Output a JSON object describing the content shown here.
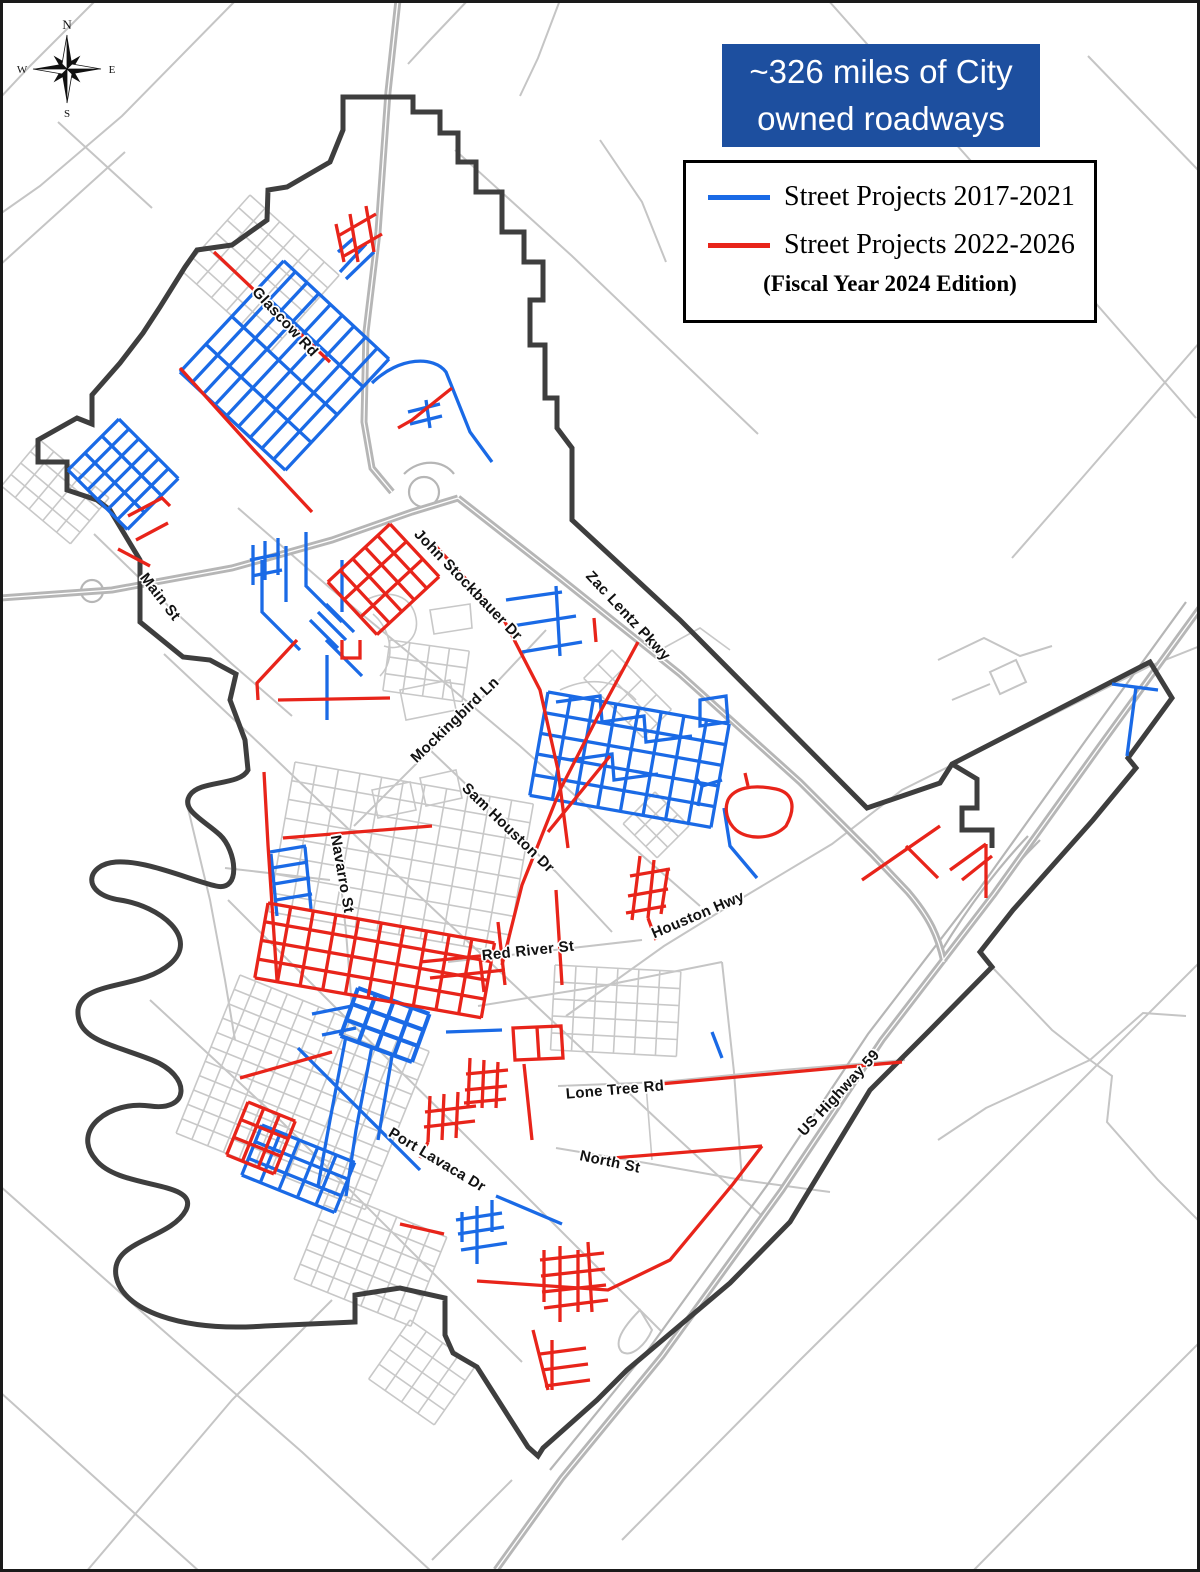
{
  "title_box": {
    "line1": "~326 miles of City",
    "line2": "owned roadways",
    "bg_color": "#1d4f9f",
    "text_color": "#ffffff"
  },
  "legend": {
    "items": [
      {
        "label": "Street Projects 2017-2021",
        "color": "#1a6ae6"
      },
      {
        "label": "Street Projects 2022-2026",
        "color": "#e8241a"
      }
    ],
    "note": "(Fiscal Year 2024 Edition)"
  },
  "compass": {
    "n": "N",
    "s": "S",
    "e": "E",
    "w": "W"
  },
  "street_labels": [
    {
      "text": "Glascow Rd",
      "x": 285,
      "y": 322,
      "angle": 47
    },
    {
      "text": "Main St",
      "x": 160,
      "y": 597,
      "angle": 52
    },
    {
      "text": "John Stockbauer Dr",
      "x": 468,
      "y": 585,
      "angle": 46
    },
    {
      "text": "Zac Lentz Pkwy",
      "x": 628,
      "y": 616,
      "angle": 47
    },
    {
      "text": "Mockingbird Ln",
      "x": 455,
      "y": 720,
      "angle": -44
    },
    {
      "text": "Sam Houston Dr",
      "x": 508,
      "y": 828,
      "angle": 44
    },
    {
      "text": "Navarro St",
      "x": 342,
      "y": 874,
      "angle": 80
    },
    {
      "text": "Red River St",
      "x": 528,
      "y": 951,
      "angle": -6
    },
    {
      "text": "Houston Hwy",
      "x": 698,
      "y": 915,
      "angle": -23
    },
    {
      "text": "Lone Tree Rd",
      "x": 615,
      "y": 1090,
      "angle": -5
    },
    {
      "text": "North St",
      "x": 610,
      "y": 1162,
      "angle": 12
    },
    {
      "text": "Port Lavaca Dr",
      "x": 437,
      "y": 1160,
      "angle": 31
    },
    {
      "text": "US Highway 59",
      "x": 839,
      "y": 1093,
      "angle": -47
    }
  ],
  "map": {
    "colors": {
      "county_roads": "#c5c5c5",
      "highways": "#b6b6b6",
      "city_streets": "#c8c8c8",
      "city_boundary": "#3e3e3e",
      "projects_2017_2021": "#1a6ae6",
      "projects_2022_2026": "#e8241a"
    },
    "layers": [
      {
        "name": "county-roads",
        "color": "#c5c5c5",
        "width": 2,
        "paths": [
          "M96,0 L30,66 L0,98",
          "M236,0 L122,116 L40,186 L0,214",
          "M0,265 L125,152",
          "M58,122 L152,208",
          "M468,0 L430,40 L408,64",
          "M560,0 L538,58 L520,96",
          "M828,0 L1002,196 L1196,418",
          "M912,92 L1014,56",
          "M1088,56 L1200,172",
          "M1200,342 L1082,478 L1012,558",
          "M0,1186 L142,1312 L302,1452 L432,1572",
          "M86,1572 L232,1400 L332,1300",
          "M0,1392 L122,1502 L200,1572",
          "M512,1480 L432,1560",
          "M1200,962 L1002,1160 L800,1360 L622,1540",
          "M972,1572 L1102,1440 L1200,1342",
          "M455,150 L572,256 L666,346 L758,434",
          "M566,1016 L664,946 L742,898 L832,844 L902,790 L1054,714 L1150,666 L1200,646",
          "M94,534 L162,600 L232,664 L292,716",
          "M354,826 L422,758 L482,698 L546,630",
          "M428,748 L472,790 L556,872 L612,932",
          "M448,962 L572,948 L642,940",
          "M558,1086 L662,1082 L782,1070 L905,1060",
          "M556,1148 L652,1164 L742,1180 L830,1192",
          "M336,836 L346,932 L352,1008",
          "M238,508 L330,588 L420,662 L520,746 L620,836 L700,906",
          "M164,654 L262,746 L362,842 L462,936 L562,1030 L662,1124 L762,1216",
          "M228,900 L340,1012 L452,1122 L562,1232 L662,1332",
          "M150,1000 L282,1122 L422,1262 L522,1362",
          "M478,1006 L602,986 L722,962",
          "M722,962 L734,1072 L742,1180",
          "M992,967 L1052,1030 L1090,1060 L1143,1013 L1186,1016",
          "M1090,1060 L1112,1076 L1107,1122 L1158,1180 L1200,1222",
          "M1090,1060 L986,1108 L938,1140",
          "M186,800 L210,900 L225,980 L235,1040",
          "M225,868 L330,880",
          "M938,660 L984,638 L1020,656 L1052,646",
          "M990,672 L1016,660 L1026,682 L1000,694 Z",
          "M952,700 L990,684",
          "M640,1310 C620,1330 614,1344 622,1352 C632,1358 646,1344 652,1330 Z",
          "M600,140 L642,202 L666,262"
        ]
      },
      {
        "name": "highways",
        "color": "#b6b6b6",
        "width": 7,
        "paths": [
          "M398,0 L388,92 L378,232 L366,332 L364,422 L372,468 L392,492",
          "M0,598 L112,590 L232,568 L332,540 L412,512 L458,498",
          "M458,498 L560,578 L680,674 L800,782 L872,854 L908,892 C930,918 938,936 944,962",
          "M1200,608 L1100,746 L994,894 L882,1040 L782,1190 L662,1356 L562,1478 L496,1570"
        ]
      },
      {
        "name": "highway-ramps",
        "color": "#b6b6b6",
        "width": 2.2,
        "paths": [
          "M404,474 C420,458 444,460 454,474",
          "M439,492 a15,15 0 1,0 -30,0 a15,15 0 1,0 30,0",
          "M103,591 a11,11 0 1,0 -22,0 a11,11 0 1,0 22,0",
          "M1040,840 C1000,880 970,920 948,958",
          "M1028,836 C992,874 964,914 942,950",
          "M1186,602 L1086,740 L980,888 L868,1034 L768,1184 L648,1350 L550,1470"
        ]
      },
      {
        "name": "highway-centerline",
        "color": "#ffffff",
        "width": 1.3,
        "paths": [
          "M398,0 L388,92 L378,232 L366,332 L364,422 L372,468 L392,492",
          "M0,598 L112,590 L232,568 L332,540 L412,512 L458,498",
          "M458,498 L560,578 L680,674 L800,782 L872,854 L908,892 C930,918 938,936 944,962",
          "M1200,608 L1100,746 L994,894 L882,1040 L782,1190 L662,1356 L562,1478 L496,1570"
        ]
      },
      {
        "name": "city-streets",
        "color": "#c8c8c8",
        "width": 1.6,
        "paths": [
          "M366,600 C390,588 412,596 416,618 C420,640 400,652 384,646",
          "M430,610 L470,604 L472,628 L434,634 Z",
          "M560,690 C590,676 618,680 636,700",
          "M660,650 L700,628 L730,650",
          "M372,790 L410,782 L416,810 L378,818 Z",
          "M420,778 L456,770 L462,798 L426,806 Z",
          "M646,1085 L652,1160",
          "M373,614 C392,630 396,660 380,676",
          "M400,690 L450,680 L456,710 L406,720 Z"
        ]
      },
      {
        "name": "city-boundary",
        "color": "#3e3e3e",
        "width": 5,
        "paths": [
          "M343,130 L343,97 L413,97 L413,112 L440,112 L440,133 L458,133 L458,162 L476,162 L476,192 L502,192 L502,232 L524,232 L524,262 L543,262 L543,300 L530,300 L530,345 L545,345 L545,398 L557,398 L557,428 L572,448 L572,520 L680,620 L867,808 L940,783 L952,764 L1150,662 L1172,698 L1128,758 L1136,768 L1093,820 L1013,910 L980,952 L992,967 L930,1030 L870,1090 L790,1222 L730,1283 L627,1370 L597,1400 L543,1448 L538,1456 L528,1447 L477,1367 L453,1353 L445,1335 L445,1298 L400,1288 L355,1295 L355,1322 L265,1326 C180,1332 122,1310 116,1276 C110,1240 170,1240 186,1210 C200,1180 120,1190 96,1160 C70,1130 110,1100 150,1106 C190,1112 192,1076 152,1060 C112,1044 76,1040 78,1010 C82,980 140,990 170,964 C200,938 160,906 120,900 C80,894 86,864 116,862 C146,860 190,880 216,886 C242,892 236,850 220,835 C204,820 180,810 190,795 C200,780 240,786 248,770 L245,740 L230,700 L236,674 L210,660 L183,657 L140,622 L140,560 L110,510 L97,500 L67,490 L67,462 L38,462 L38,440 L77,418 L92,424 L92,395 L120,363 L143,333 L160,307 L185,267 L197,250 L232,245 L267,220 L268,190 L287,187 L330,162 Z",
          "M952,764 L977,779 L977,808 L962,808 L962,830 L992,830 L992,848"
        ]
      },
      {
        "name": "projects-2017-2021",
        "color": "#1a6ae6",
        "width": 3.3,
        "paths": [
          "M372,383 C400,356 434,356 446,372 L470,432 L492,462",
          "M408,412 L440,404 M410,424 L442,416 M426,400 L430,428",
          "M340,272 L366,244 M346,279 L374,252 M338,252 L354,238",
          "M262,560 L262,612 L300,650",
          "M286,546 L286,602",
          "M306,532 L306,586 L342,622",
          "M326,640 L362,676",
          "M342,560 L342,612",
          "M310,620 L338,648 M318,612 L346,640 M326,604 L354,632",
          "M327,655 L327,720",
          "M253,545 L253,585 M265,541 L265,580 M278,538 L278,575 M250,560 L280,554 M252,576 L282,570",
          "M506,600 L562,592 M512,626 L576,616 M522,652 L582,642 M556,586 L560,656",
          "M556,702 L600,696 L602,722 L644,716 L646,742 L692,736",
          "M570,760 L612,754 L614,780 L658,774",
          "M700,700 L726,696 L728,722 L700,726 Z",
          "M698,806 L702,786 L722,780 M702,786 L696,778",
          "M724,808 L730,846 L757,878",
          "M1112,684 L1158,690 M1136,687 L1127,756",
          "M446,1032 L502,1030",
          "M712,1032 L722,1058",
          "M298,1048 L420,1170",
          "M346,1036 L330,1120 L318,1186",
          "M372,1046 L356,1130 L346,1196",
          "M392,1056 L378,1140",
          "M477,1206 L477,1264 M462,1212 L462,1242 M492,1200 L492,1232 M456,1220 L502,1213 M458,1234 L504,1227 M461,1250 L507,1243 M496,1196 L562,1224",
          "M270,852 L306,846 M272,868 L308,862 M274,884 L310,878 M276,900 L312,894 M271,854 L277,916 M305,847 L311,909",
          "M352,1006 L312,1014 M356,1028 L322,1035"
        ]
      },
      {
        "name": "projects-2022-2026",
        "color": "#e8241a",
        "width": 3.3,
        "paths": [
          "M214,252 L330,362",
          "M180,368 L254,450 L312,512",
          "M338,236 L376,214 M344,256 L382,234 M350,214 L358,262 M366,206 L374,252 M336,224 L344,262",
          "M452,388 L412,420 L398,428",
          "M433,543 L505,622 L540,690 L558,770 L568,848",
          "M556,890 L562,985",
          "M638,642 L598,716 L560,790 L522,885 L502,965",
          "M594,618 L596,642",
          "M283,838 L432,826",
          "M610,756 L548,832",
          "M640,856 L632,920 M654,860 L648,918 M668,868 L661,914 M630,876 L670,869 M628,896 L668,889 M626,913 L666,906 M648,918 L656,940",
          "M728,800 C734,788 752,784 776,789 C794,793 796,808 786,826 C772,840 748,840 736,830 C727,822 724,810 728,800 Z M748,786 L745,773",
          "M862,880 L940,826 M906,846 L938,878 M950,870 L986,844 M986,844 L986,898 M962,880 L992,856",
          "M420,962 L500,954 M430,978 L505,970 M480,958 L484,992 M498,922 L505,985",
          "M513,1028 L561,1026 L563,1058 L515,1060 Z M537,1027 L539,1059",
          "M470,1058 L468,1106 M484,1060 L482,1108 M498,1062 L496,1108 M466,1074 L508,1070 M465,1090 L507,1086 M464,1103 L506,1099",
          "M524,1064 L532,1140",
          "M588,1160 L762,1146",
          "M762,1146 L733,1184 L670,1260 L608,1290 L477,1281",
          "M660,1084 L902,1062",
          "M560,1246 L560,1322 M544,1250 L544,1302 M578,1250 L578,1312 M540,1260 L604,1253 M541,1276 L605,1269 M542,1292 L606,1285 M544,1308 L608,1300 M588,1242 L592,1312",
          "M552,1340 L552,1390 M540,1354 L586,1348 M542,1370 L588,1364 M545,1386 L590,1380 M533,1330 L548,1390",
          "M430,1096 L428,1142 M444,1094 L442,1140 M458,1092 L456,1138 M425,1112 L476,1106 M424,1127 L475,1121 M428,1142 L420,1158",
          "M128,516 L162,498 L170,506 M136,540 L168,523 M118,549 L150,566",
          "M240,1078 L332,1052",
          "M264,772 L268,845 L273,920 L277,980",
          "M400,1224 L444,1234",
          "M297,640 L257,683 L258,700",
          "M278,700 L390,698",
          "M342,640 L342,658 L360,658 L360,640"
        ]
      }
    ],
    "grids": [
      {
        "layer": "city-streets",
        "x": 250,
        "y": 195,
        "angle": 42,
        "cols": 6,
        "rows": 6,
        "cw": 20,
        "ch": 17
      },
      {
        "layer": "city-streets",
        "x": 40,
        "y": 440,
        "angle": 40,
        "cols": 5,
        "rows": 4,
        "cw": 18,
        "ch": 15
      },
      {
        "layer": "city-streets",
        "x": 390,
        "y": 640,
        "angle": 8,
        "cols": 4,
        "rows": 3,
        "cw": 20,
        "ch": 17
      },
      {
        "layer": "city-streets",
        "x": 295,
        "y": 762,
        "angle": 10,
        "cols": 11,
        "rows": 8,
        "cw": 22,
        "ch": 19
      },
      {
        "layer": "city-streets",
        "x": 240,
        "y": 975,
        "angle": 22,
        "cols": 12,
        "rows": 11,
        "cw": 17,
        "ch": 15.5
      },
      {
        "layer": "city-streets",
        "x": 612,
        "y": 650,
        "angle": 45,
        "cols": 4,
        "rows": 2,
        "cw": 21,
        "ch": 20
      },
      {
        "layer": "city-streets",
        "x": 555,
        "y": 965,
        "angle": 3,
        "cols": 6,
        "rows": 5,
        "cw": 21,
        "ch": 17
      },
      {
        "layer": "city-streets",
        "x": 655,
        "y": 792,
        "angle": 45,
        "cols": 3,
        "rows": 3,
        "cw": 16,
        "ch": 15
      },
      {
        "layer": "city-streets",
        "x": 330,
        "y": 1190,
        "angle": 22,
        "cols": 7,
        "rows": 6,
        "cw": 18,
        "ch": 16
      },
      {
        "layer": "city-streets",
        "x": 410,
        "y": 1320,
        "angle": 35,
        "cols": 4,
        "rows": 4,
        "cw": 20,
        "ch": 18
      },
      {
        "layer": "projects-2017-2021",
        "x": 180,
        "y": 372,
        "angle": -47,
        "cols": 4,
        "rows": 9,
        "cw": 38,
        "ch": 16
      },
      {
        "layer": "projects-2017-2021",
        "x": 68,
        "y": 470,
        "angle": -45,
        "cols": 3,
        "rows": 6,
        "cw": 24,
        "ch": 14
      },
      {
        "layer": "projects-2017-2021",
        "x": 548,
        "y": 692,
        "angle": 10,
        "cols": 8,
        "rows": 5,
        "cw": 23,
        "ch": 21
      },
      {
        "layer": "projects-2017-2021",
        "x": 358,
        "y": 988,
        "angle": 20,
        "cols": 4,
        "rows": 3,
        "cw": 19,
        "ch": 17,
        "width": 4.2
      },
      {
        "layer": "projects-2017-2021",
        "x": 262,
        "y": 1125,
        "angle": 22,
        "cols": 5,
        "rows": 3,
        "cw": 20,
        "ch": 18
      },
      {
        "layer": "projects-2022-2026",
        "x": 248,
        "y": 1102,
        "angle": 22,
        "cols": 3,
        "rows": 3,
        "cw": 17,
        "ch": 19
      },
      {
        "layer": "projects-2022-2026",
        "x": 390,
        "y": 524,
        "angle": 47,
        "cols": 3,
        "rows": 5,
        "cw": 24,
        "ch": 17
      },
      {
        "layer": "projects-2022-2026",
        "x": 268,
        "y": 903,
        "angle": 10,
        "cols": 10,
        "rows": 4,
        "cw": 23,
        "ch": 19
      }
    ]
  }
}
